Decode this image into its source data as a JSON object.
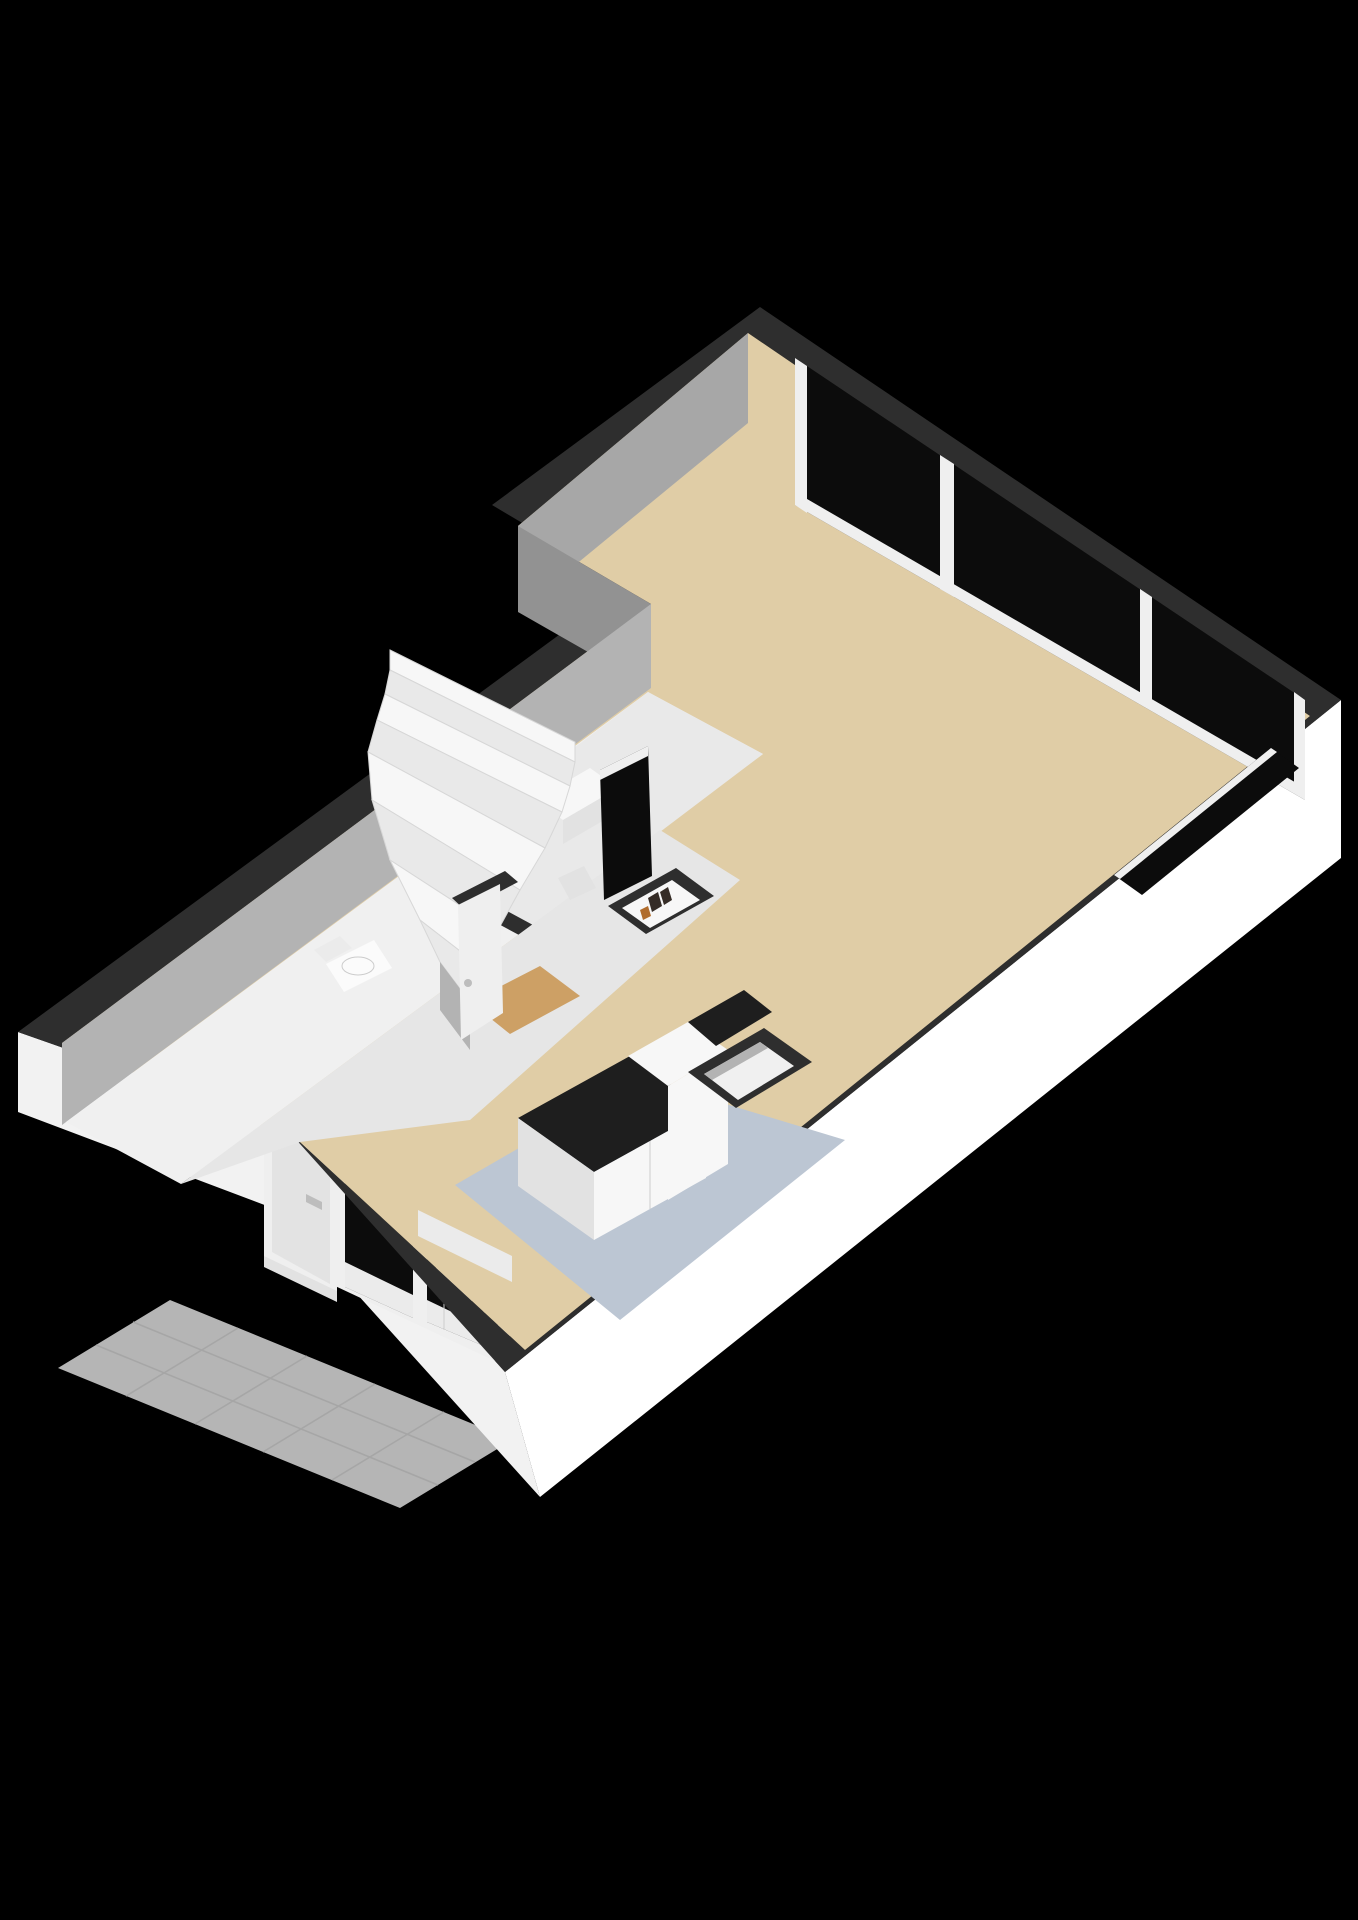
{
  "scene": {
    "type": "3d-floor-plan-render",
    "view": "isometric-dollhouse",
    "floor_shown": "ground-floor",
    "visible_text": "none"
  },
  "palette": {
    "background": "#000000",
    "wall_top": "#2e2e2e",
    "wall_outer_white": "#ffffff",
    "wall_outer_shade": "#f2f2f2",
    "wall_inner_gray": "#a7a7a7",
    "wall_inner_gray_dark": "#929292",
    "wall_inner_gray_light": "#b3b3b3",
    "floor_living": "#e0cda6",
    "floor_kitchen": "#bcc6d3",
    "floor_room": "#f0f0f0",
    "floor_room2": "#e9e9e9",
    "floor_hall": "#e6e6e6",
    "floor_landing": "#cda065",
    "terrace_tile": "#b5b5b5",
    "glass": "#0c0c0c",
    "frame_white": "#efefef",
    "door_slab": "#e3e3e3",
    "counter_dark": "#1e1e1e",
    "cabinet_white": "#f7f7f7",
    "cabinet_side": "#e2e2e2",
    "fixture_white": "#fbfbfb",
    "appliance_white": "#ebebeb",
    "shelf_item_dark": "#352c26",
    "shelf_item_accent": "#b06c2c",
    "handle_gray": "#bdbdbd"
  },
  "rooms": [
    {
      "id": "living-room",
      "floor_color_key": "floor_living"
    },
    {
      "id": "kitchen",
      "floor_color_key": "floor_kitchen"
    },
    {
      "id": "hall-stairwell",
      "floor_color_key": "floor_hall"
    },
    {
      "id": "toilet",
      "floor_color_key": "floor_room"
    },
    {
      "id": "storage-room",
      "floor_color_key": "floor_room2"
    },
    {
      "id": "outdoor-terrace",
      "floor_color_key": "terrace_tile"
    }
  ],
  "fixtures": {
    "staircase": {
      "kind": "winder",
      "straight_steps": 3,
      "winder_steps": 5
    },
    "facade_glazing_panes": 3,
    "side_glazing_panes": 1,
    "kitchen_window_panes": 2,
    "doors": [
      "front-door",
      "hall-door"
    ],
    "equipment": [
      "boiler",
      "sink",
      "toilet",
      "kitchen-counter",
      "meter-closet-shelf",
      "storage-niche",
      "cabinet"
    ]
  }
}
